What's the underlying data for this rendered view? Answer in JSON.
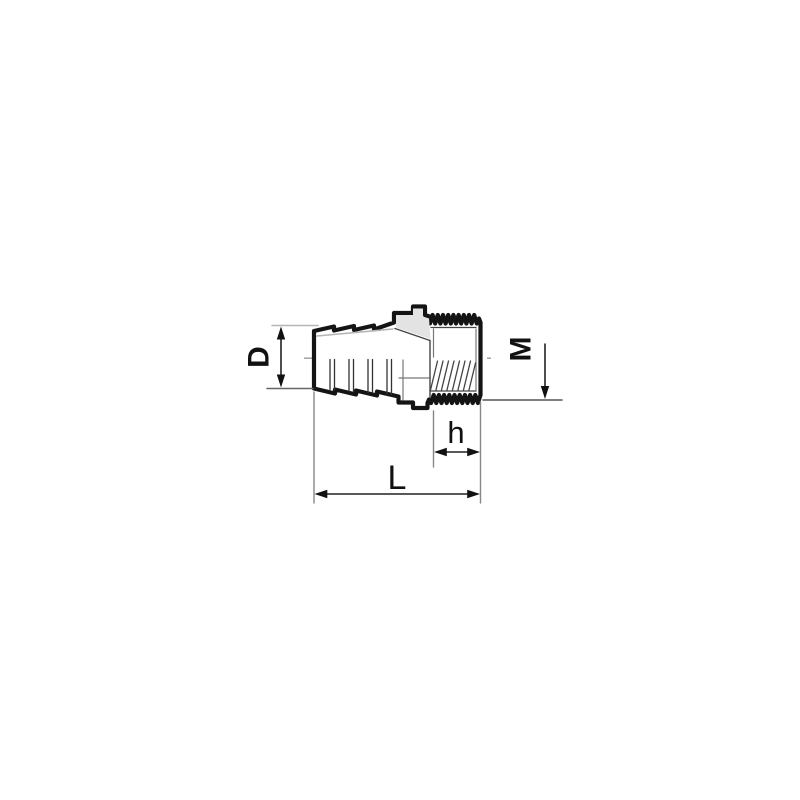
{
  "drawing": {
    "description": "Dimensioned line drawing of a hose barb adapter with male threaded end",
    "dimensions": {
      "outer_diameter_label": "D",
      "thread_size_label": "M",
      "thread_length_label": "h",
      "overall_length_label": "L"
    },
    "colors": {
      "outline": "#141414",
      "chamfer_shade": "#e3e3e3",
      "centerline": "#999999",
      "dimension_line": "#222222",
      "background": "#ffffff"
    }
  }
}
